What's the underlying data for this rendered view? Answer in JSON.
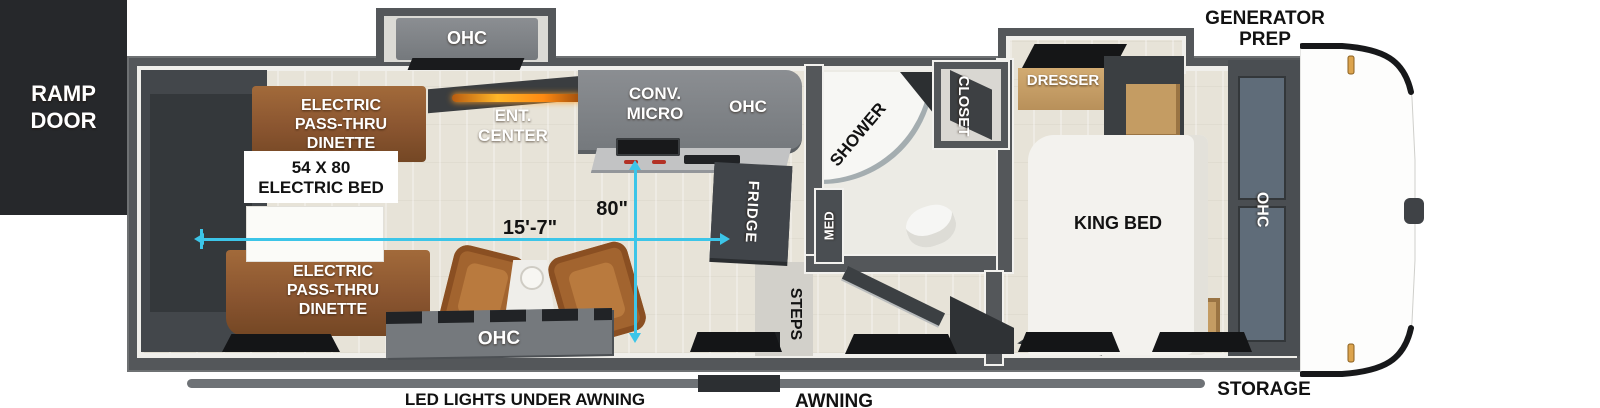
{
  "colors": {
    "accent_cyan": "#3cc5e8",
    "wall_gray": "#54575a",
    "ramp_black": "#26282b",
    "dinette_wood": "#8a5530",
    "light_wood": "#c49c63",
    "fireplace_glow": "#ffa21e"
  },
  "exterior": {
    "ramp_door_line1": "RAMP",
    "ramp_door_line2": "DOOR",
    "generator_line1": "GENERATOR",
    "generator_line2": "PREP",
    "storage": "STORAGE",
    "awning": "AWNING",
    "led_lights": "LED LIGHTS UNDER AWNING"
  },
  "garage": {
    "dinette_top": {
      "line1": "ELECTRIC",
      "line2": "PASS-THRU",
      "line3": "DINETTE"
    },
    "dinette_bottom": {
      "line1": "ELECTRIC",
      "line2": "PASS-THRU",
      "line3": "DINETTE"
    },
    "bed_line1": "54 X 80",
    "bed_line2": "ELECTRIC BED"
  },
  "kitchen": {
    "slide_ohc": "OHC",
    "ent_line1": "ENT.",
    "ent_line2": "CENTER",
    "conv_line1": "CONV.",
    "conv_line2": "MICRO",
    "ohc": "OHC",
    "fridge": "FRIDGE",
    "bottom_ohc": "OHC"
  },
  "bath": {
    "shower": "SHOWER",
    "med": "MED",
    "closet": "CLOSET",
    "steps": "STEPS"
  },
  "bedroom": {
    "dresser": "DRESSER",
    "king_bed": "KING BED",
    "ohc": "OHC"
  },
  "dimensions": {
    "length": "15'-7\"",
    "slide_depth": "80\""
  }
}
